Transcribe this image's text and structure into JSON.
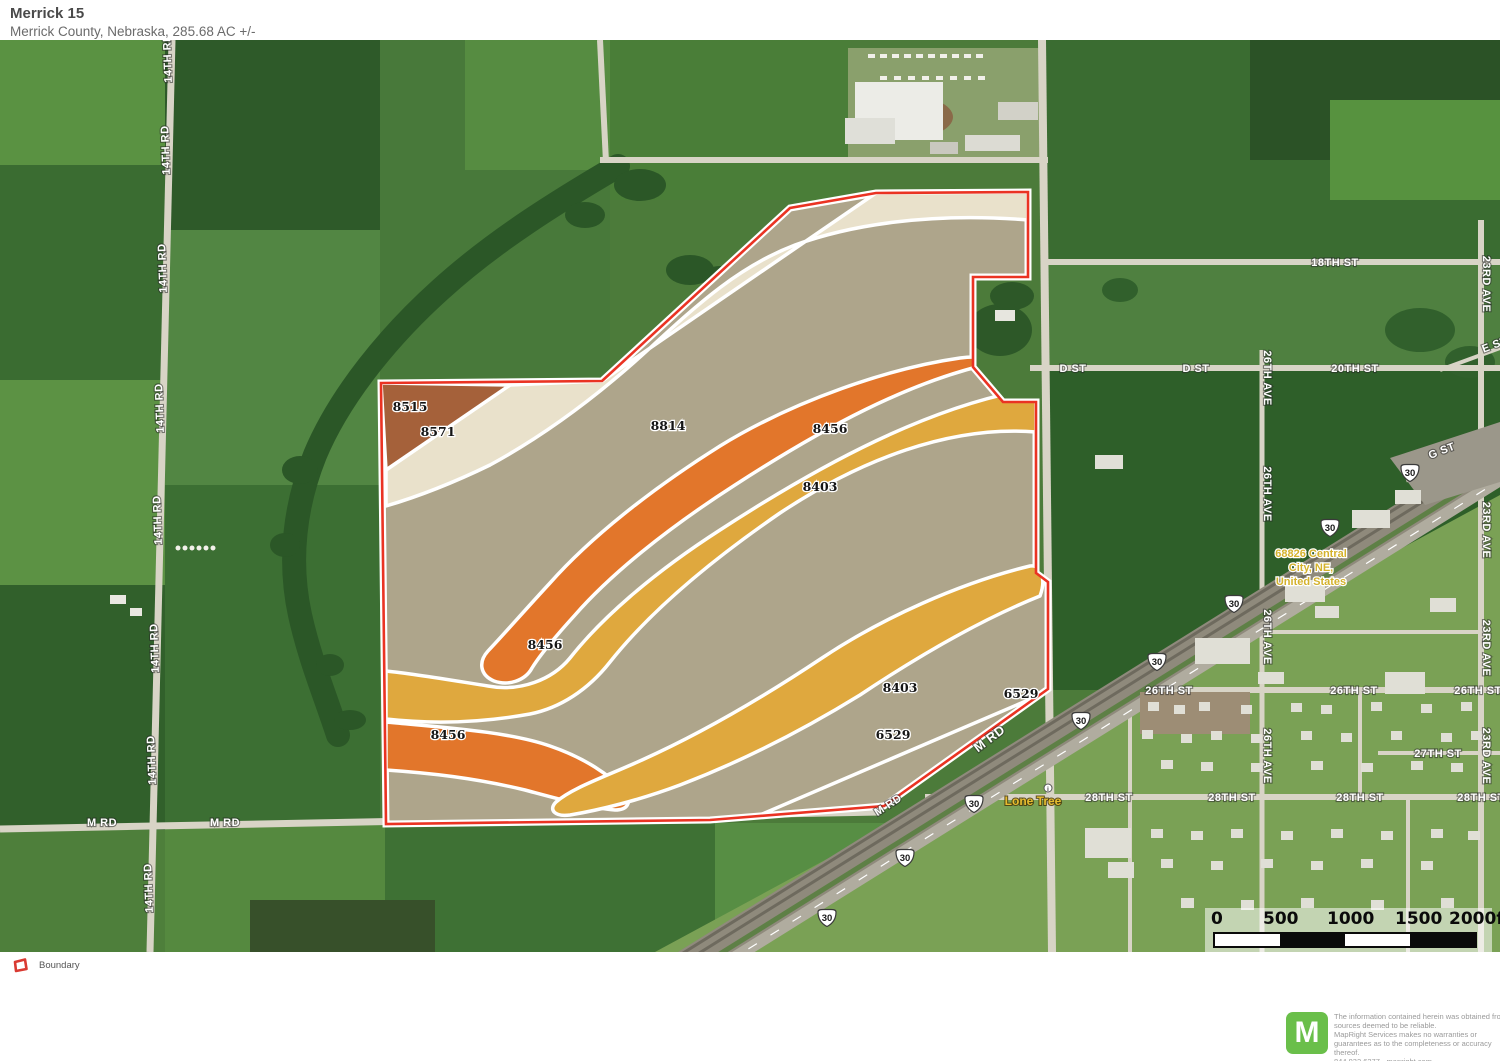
{
  "header": {
    "title": "Merrick 15",
    "subtitle": "Merrick County, Nebraska, 285.68 AC +/-"
  },
  "legend": {
    "items": [
      {
        "label": "Boundary",
        "color": "#ea3323"
      }
    ]
  },
  "scale_bar": {
    "ticks": [
      "0",
      "500",
      "1000",
      "1500",
      "2000ft"
    ]
  },
  "footer": {
    "logo_letter": "M",
    "logo_color": "#6abf4a",
    "disclaimer": "The information contained herein was obtained from sources deemed to be reliable.\n MapRight Services makes no warranties or guarantees as to the completeness or accuracy thereof.\n 844.932.6277 - mapright.com"
  },
  "map": {
    "boundary_color": "#ea3323",
    "soil_labels": [
      {
        "code": "8515",
        "x": 410,
        "y": 371
      },
      {
        "code": "8571",
        "x": 438,
        "y": 396
      },
      {
        "code": "8814",
        "x": 668,
        "y": 390
      },
      {
        "code": "8456",
        "x": 830,
        "y": 393
      },
      {
        "code": "8403",
        "x": 820,
        "y": 451
      },
      {
        "code": "8456",
        "x": 545,
        "y": 609
      },
      {
        "code": "8456",
        "x": 448,
        "y": 699
      },
      {
        "code": "8403",
        "x": 900,
        "y": 652
      },
      {
        "code": "6529",
        "x": 893,
        "y": 699
      },
      {
        "code": "6529",
        "x": 1021,
        "y": 658
      }
    ],
    "road_labels": [
      {
        "text": "14TH RD",
        "x": 171,
        "y": 18,
        "rot": -92
      },
      {
        "text": "14TH RD",
        "x": 169,
        "y": 110,
        "rot": -92
      },
      {
        "text": "14TH RD",
        "x": 166,
        "y": 228,
        "rot": -92
      },
      {
        "text": "14TH RD",
        "x": 163,
        "y": 368,
        "rot": -92
      },
      {
        "text": "14TH RD",
        "x": 161,
        "y": 480,
        "rot": -92
      },
      {
        "text": "14TH RD",
        "x": 158,
        "y": 608,
        "rot": -92
      },
      {
        "text": "14TH RD",
        "x": 155,
        "y": 720,
        "rot": -92
      },
      {
        "text": "14TH RD",
        "x": 152,
        "y": 848,
        "rot": -92
      },
      {
        "text": "M RD",
        "x": 102,
        "y": 786,
        "rot": 0
      },
      {
        "text": "M RD",
        "x": 225,
        "y": 786,
        "rot": 0
      },
      {
        "text": "M RD",
        "x": 890,
        "y": 768,
        "rot": -33
      },
      {
        "text": "M RD",
        "x": 992,
        "y": 702,
        "rot": -37,
        "size": 13
      },
      {
        "text": "18TH ST",
        "x": 1335,
        "y": 226,
        "rot": 0
      },
      {
        "text": "D ST",
        "x": 1073,
        "y": 332,
        "rot": 0
      },
      {
        "text": "D ST",
        "x": 1196,
        "y": 332,
        "rot": 0
      },
      {
        "text": "20TH ST",
        "x": 1355,
        "y": 332,
        "rot": 0
      },
      {
        "text": "23RD AVE",
        "x": 1483,
        "y": 244,
        "rot": 90
      },
      {
        "text": "23RD AVE",
        "x": 1483,
        "y": 490,
        "rot": 90
      },
      {
        "text": "23RD AVE",
        "x": 1483,
        "y": 608,
        "rot": 90
      },
      {
        "text": "23RD AVE",
        "x": 1483,
        "y": 716,
        "rot": 90
      },
      {
        "text": "26TH AVE",
        "x": 1264,
        "y": 338,
        "rot": 90
      },
      {
        "text": "26TH AVE",
        "x": 1264,
        "y": 454,
        "rot": 90
      },
      {
        "text": "26TH AVE",
        "x": 1264,
        "y": 597,
        "rot": 90
      },
      {
        "text": "26TH AVE",
        "x": 1264,
        "y": 716,
        "rot": 90
      },
      {
        "text": "G ST",
        "x": 1443,
        "y": 414,
        "rot": -21
      },
      {
        "text": "E ST",
        "x": 1496,
        "y": 308,
        "rot": -21
      },
      {
        "text": "26TH ST",
        "x": 1169,
        "y": 654,
        "rot": 0
      },
      {
        "text": "26TH ST",
        "x": 1354,
        "y": 654,
        "rot": 0
      },
      {
        "text": "26TH ST",
        "x": 1478,
        "y": 654,
        "rot": 0
      },
      {
        "text": "27TH ST",
        "x": 1438,
        "y": 717,
        "rot": 0
      },
      {
        "text": "28TH ST",
        "x": 1109,
        "y": 761,
        "rot": 0
      },
      {
        "text": "28TH ST",
        "x": 1232,
        "y": 761,
        "rot": 0
      },
      {
        "text": "28TH ST",
        "x": 1360,
        "y": 761,
        "rot": 0
      },
      {
        "text": "28TH ST",
        "x": 1481,
        "y": 761,
        "rot": 0
      }
    ],
    "highway_shields": [
      {
        "route": "30",
        "x": 1410,
        "y": 433
      },
      {
        "route": "30",
        "x": 1330,
        "y": 488
      },
      {
        "route": "30",
        "x": 1234,
        "y": 564
      },
      {
        "route": "30",
        "x": 1157,
        "y": 622
      },
      {
        "route": "30",
        "x": 1081,
        "y": 681
      },
      {
        "route": "30",
        "x": 974,
        "y": 764
      },
      {
        "route": "30",
        "x": 905,
        "y": 818
      },
      {
        "route": "30",
        "x": 827,
        "y": 878
      }
    ],
    "place_labels": {
      "address": {
        "lines": [
          "68826  Central",
          "City, NE,",
          "United States"
        ],
        "x": 1311,
        "y": 517
      },
      "town": {
        "text": "Lone Tree",
        "x": 1033,
        "y": 765
      }
    }
  }
}
